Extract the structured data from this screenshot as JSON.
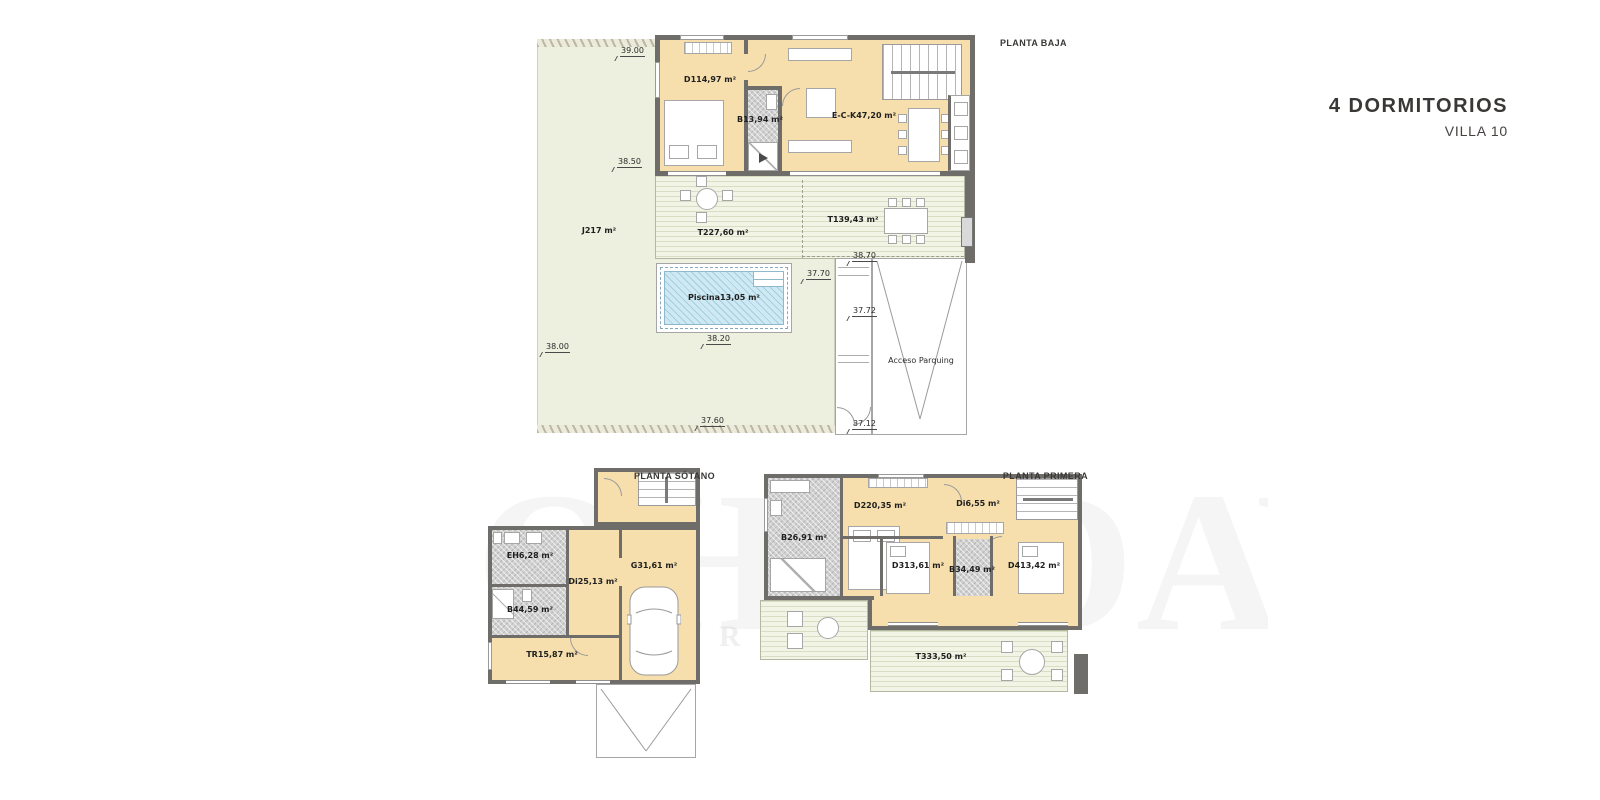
{
  "page": {
    "title": "4 DORMITORIOS",
    "subtitle": "VILLA 10"
  },
  "watermark": {
    "big": "OHN DAVID",
    "small": "LUXURY"
  },
  "plans": {
    "baja": {
      "title": "PLANTA BAJA",
      "rooms": {
        "d1": {
          "code": "D1",
          "area": "14,97 m²"
        },
        "b1": {
          "code": "B1",
          "area": "3,94 m²"
        },
        "eck": {
          "code": "E-C-K",
          "area": "47,20 m²"
        },
        "t2": {
          "code": "T2",
          "area": "27,60 m²"
        },
        "t1": {
          "code": "T1",
          "area": "39,43 m²"
        },
        "j": {
          "code": "J",
          "area": "217 m²"
        },
        "piscina": {
          "code": "Piscina",
          "area": "13,05 m²"
        },
        "acceso": {
          "line1": "Acceso",
          "line2": "Parquing"
        }
      },
      "levels": {
        "l3900": "39.00",
        "l3850": "38.50",
        "l3870": "38.70",
        "l3770": "37.70",
        "l3772": "37.72",
        "l3820": "38.20",
        "l3800": "38.00",
        "l3760": "37.60",
        "l3712": "37.12"
      }
    },
    "sotano": {
      "title": "PLANTA SÓTANO",
      "rooms": {
        "eh": {
          "code": "EH",
          "area": "6,28 m²"
        },
        "di2": {
          "code": "Di2",
          "area": "5,13 m²"
        },
        "b4": {
          "code": "B4",
          "area": "4,59 m²"
        },
        "g": {
          "code": "G",
          "area": "31,61 m²"
        },
        "tr": {
          "code": "TR",
          "area": "15,87 m²"
        }
      }
    },
    "primera": {
      "title": "PLANTA PRIMERA",
      "rooms": {
        "b2": {
          "code": "B2",
          "area": "6,91 m²"
        },
        "d2": {
          "code": "D2",
          "area": "20,35 m²"
        },
        "di": {
          "code": "Di",
          "area": "6,55 m²"
        },
        "d3": {
          "code": "D3",
          "area": "13,61 m²"
        },
        "b3": {
          "code": "B3",
          "area": "4,49 m²"
        },
        "d4": {
          "code": "D4",
          "area": "13,42 m²"
        },
        "t3": {
          "code": "T3",
          "area": "33,50 m²"
        }
      }
    }
  }
}
